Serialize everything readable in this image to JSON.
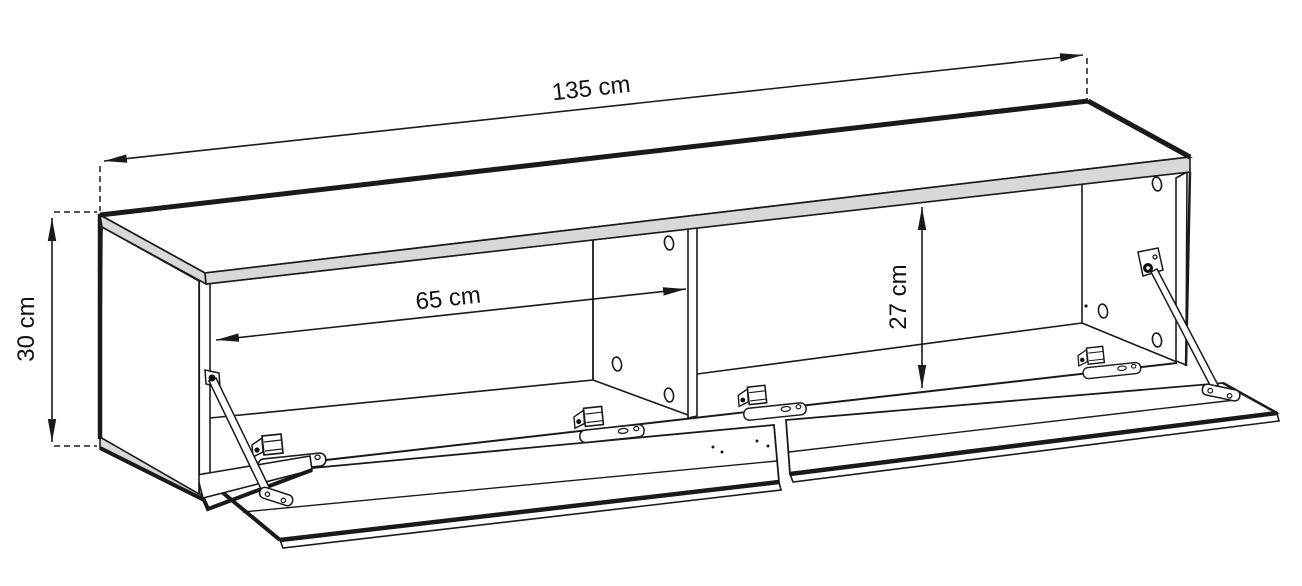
{
  "labels": {
    "width": "135 cm",
    "height": "30 cm",
    "inner_width": "65 cm",
    "inner_height": "27 cm"
  },
  "colors": {
    "line": "#1a1a1a",
    "edge_fill": "#d8d8d8",
    "background": "#ffffff"
  }
}
